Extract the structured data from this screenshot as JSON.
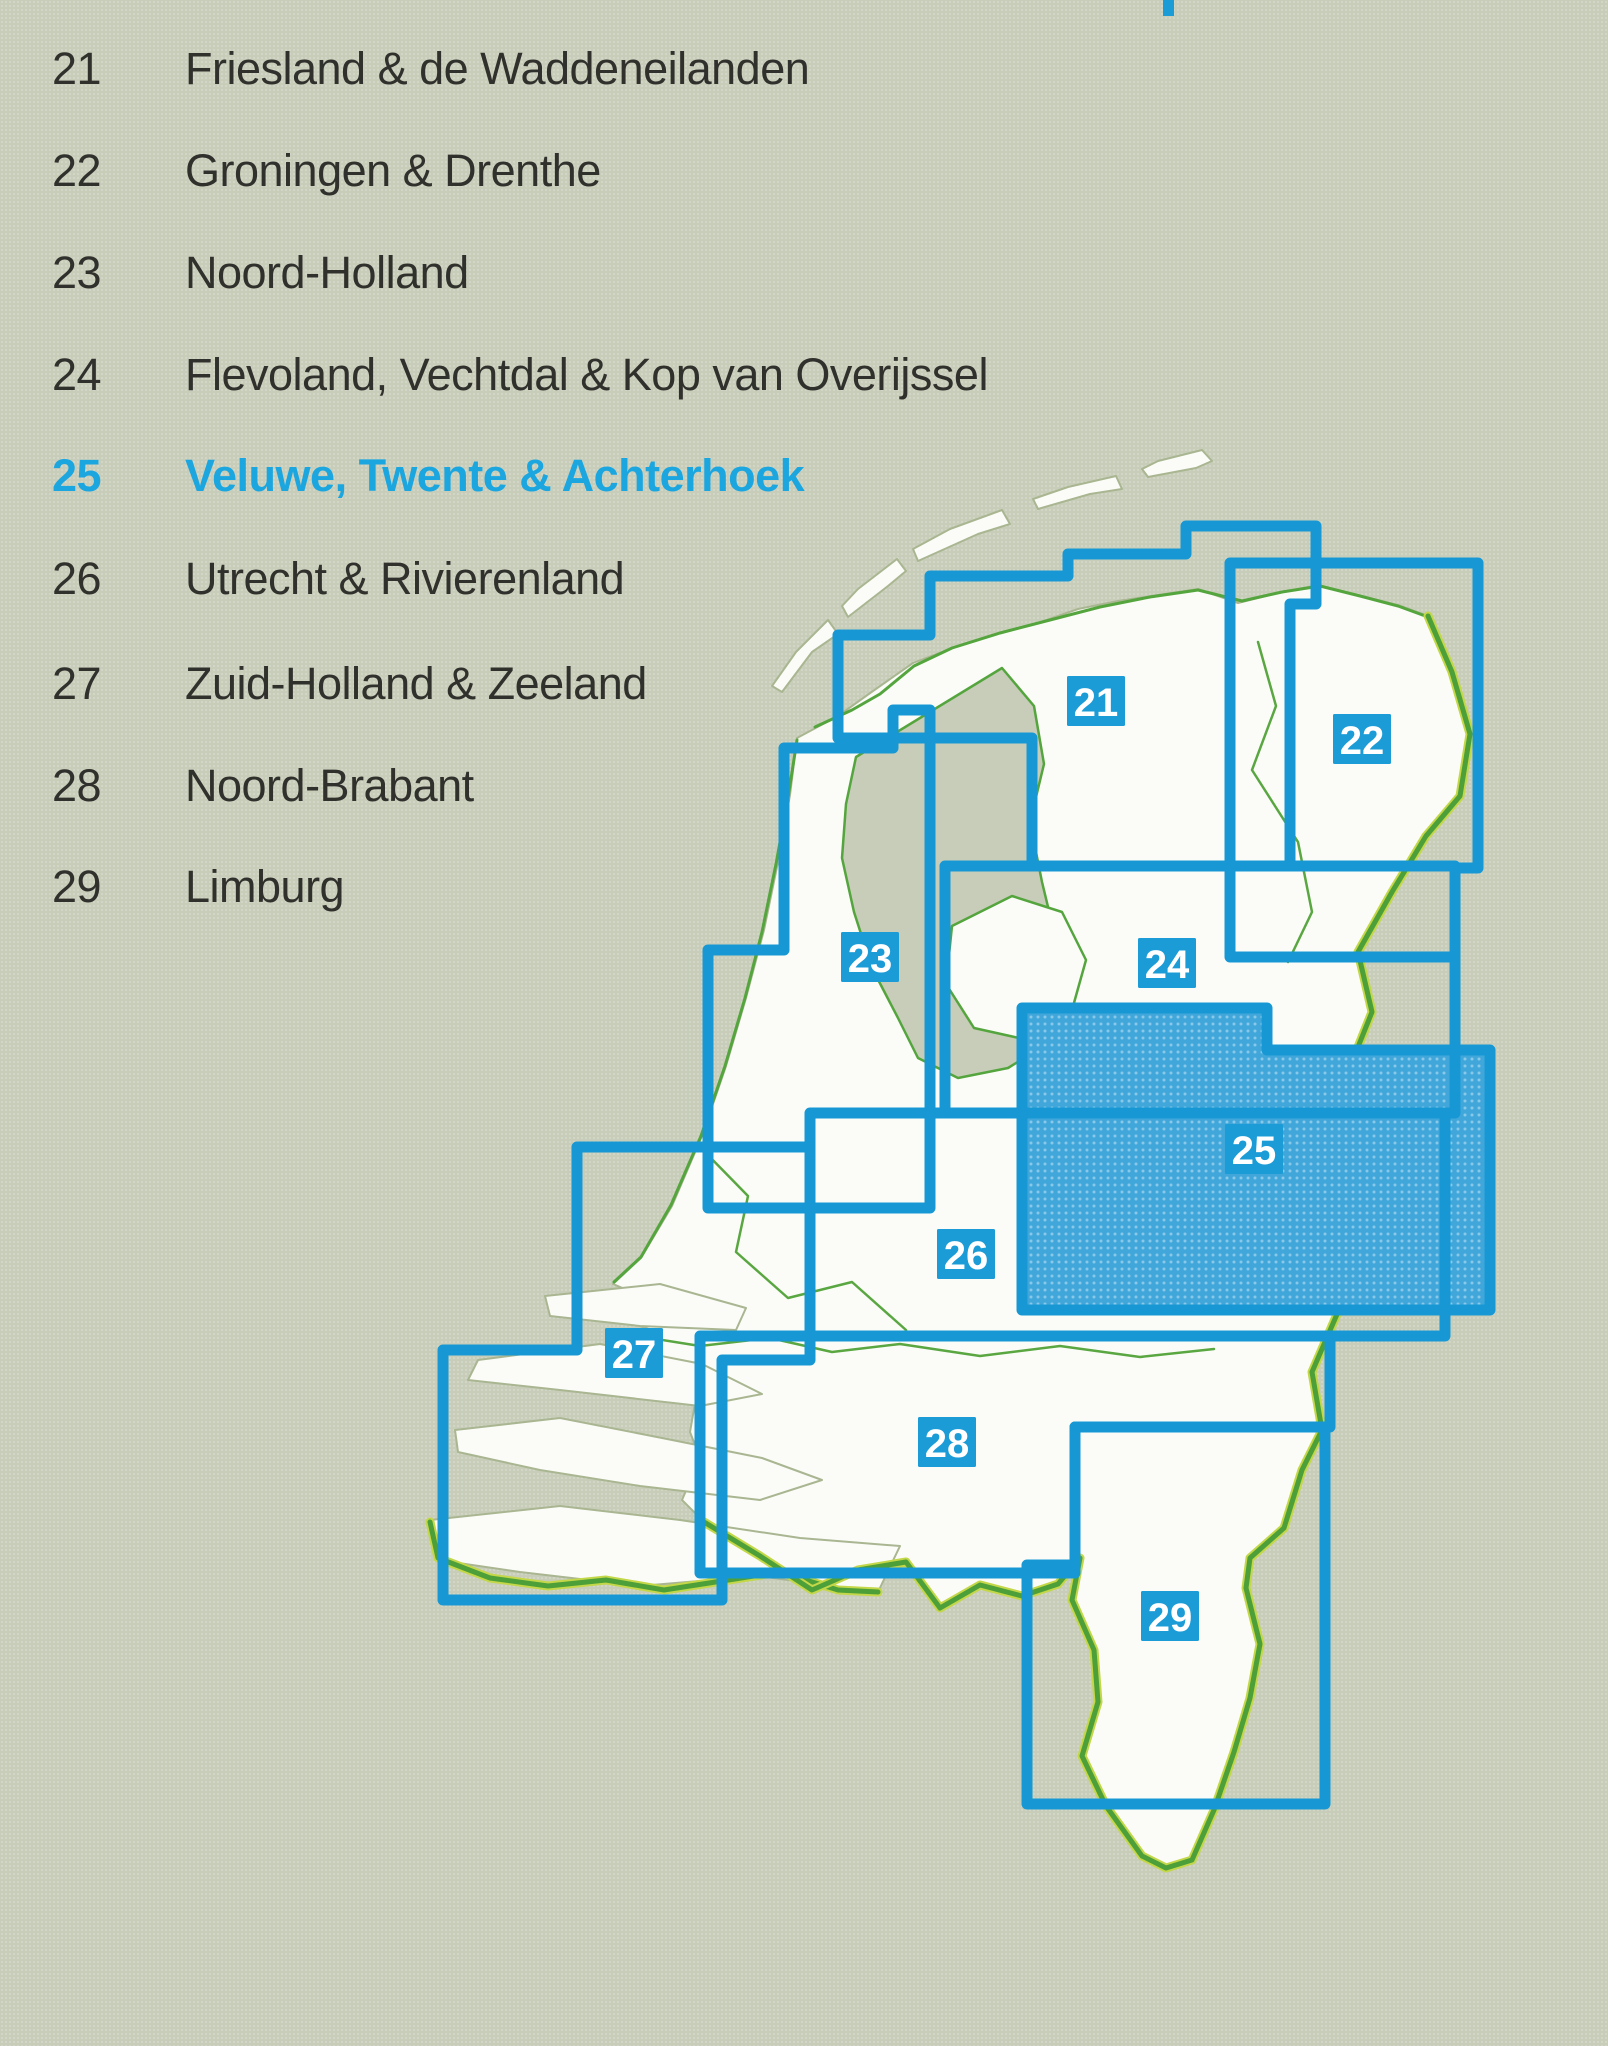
{
  "page": {
    "background": "#c8cdb9",
    "type": "map-index-page"
  },
  "legend": {
    "items": [
      {
        "num": "21",
        "label": "Friesland & de Waddeneilanden",
        "highlighted": false
      },
      {
        "num": "22",
        "label": "Groningen & Drenthe",
        "highlighted": false
      },
      {
        "num": "23",
        "label": "Noord-Holland",
        "highlighted": false
      },
      {
        "num": "24",
        "label": "Flevoland, Vechtdal & Kop van Overijssel",
        "highlighted": false
      },
      {
        "num": "25",
        "label": "Veluwe, Twente & Achterhoek",
        "highlighted": true
      },
      {
        "num": "26",
        "label": "Utrecht & Rivierenland",
        "highlighted": false
      },
      {
        "num": "27",
        "label": "Zuid-Holland & Zeeland",
        "highlighted": false
      },
      {
        "num": "28",
        "label": "Noord-Brabant",
        "highlighted": false
      },
      {
        "num": "29",
        "label": "Limburg",
        "highlighted": false
      }
    ],
    "text_color": "#30312c",
    "highlight_color": "#1ba6e0"
  },
  "map": {
    "highlighted_sheet": "25",
    "colors": {
      "sheet_outline": "#1798d4",
      "badge_fill": "#1b9cd7",
      "badge_text": "#ffffff",
      "land": "#fbfcf8",
      "sea": "#c8cdb9",
      "border_green": "#4d9f39",
      "border_fringe": "#c3d748",
      "coast_soft": "#a9b691",
      "sheet25_fill": "#41a7da"
    },
    "sheets": [
      {
        "number": "21"
      },
      {
        "number": "22"
      },
      {
        "number": "23"
      },
      {
        "number": "24"
      },
      {
        "number": "25"
      },
      {
        "number": "26"
      },
      {
        "number": "27"
      },
      {
        "number": "28"
      },
      {
        "number": "29"
      }
    ]
  }
}
